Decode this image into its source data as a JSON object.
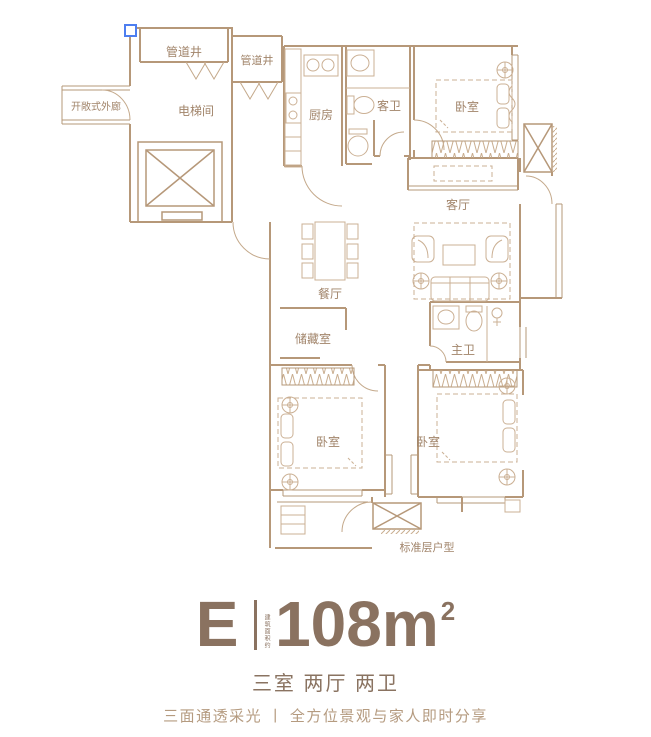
{
  "colors": {
    "wall": "#b69879",
    "thin_line": "#cbb094",
    "room_label": "#a1846a",
    "footnote": "#b49879",
    "title_text": "#8a7260",
    "tagline_text": "#b59b80",
    "selection_handle": "#4d7ef0",
    "background": "#ffffff"
  },
  "plan": {
    "rooms": [
      {
        "id": "pipe-shaft-1",
        "label": "管道井"
      },
      {
        "id": "pipe-shaft-2",
        "label": "管道井"
      },
      {
        "id": "open-corridor",
        "label": "开敞式外廊"
      },
      {
        "id": "elevator-hall",
        "label": "电梯间"
      },
      {
        "id": "kitchen",
        "label": "厨房"
      },
      {
        "id": "guest-bath",
        "label": "客卫"
      },
      {
        "id": "bedroom-ne",
        "label": "卧室"
      },
      {
        "id": "living-room",
        "label": "客厅"
      },
      {
        "id": "dining-room",
        "label": "餐厅"
      },
      {
        "id": "storage",
        "label": "储藏室"
      },
      {
        "id": "master-bath",
        "label": "主卫"
      },
      {
        "id": "bedroom-sw",
        "label": "卧室"
      },
      {
        "id": "bedroom-se",
        "label": "卧室"
      }
    ],
    "footnote": "标准层户型"
  },
  "caption": {
    "unit_letter": "E",
    "area_note_vertical": "建筑面积约",
    "area_value": "108m",
    "area_sup": "2",
    "layout": "三室 两厅 两卫",
    "tagline": "三面通透采光 丨 全方位景观与家人即时分享"
  }
}
